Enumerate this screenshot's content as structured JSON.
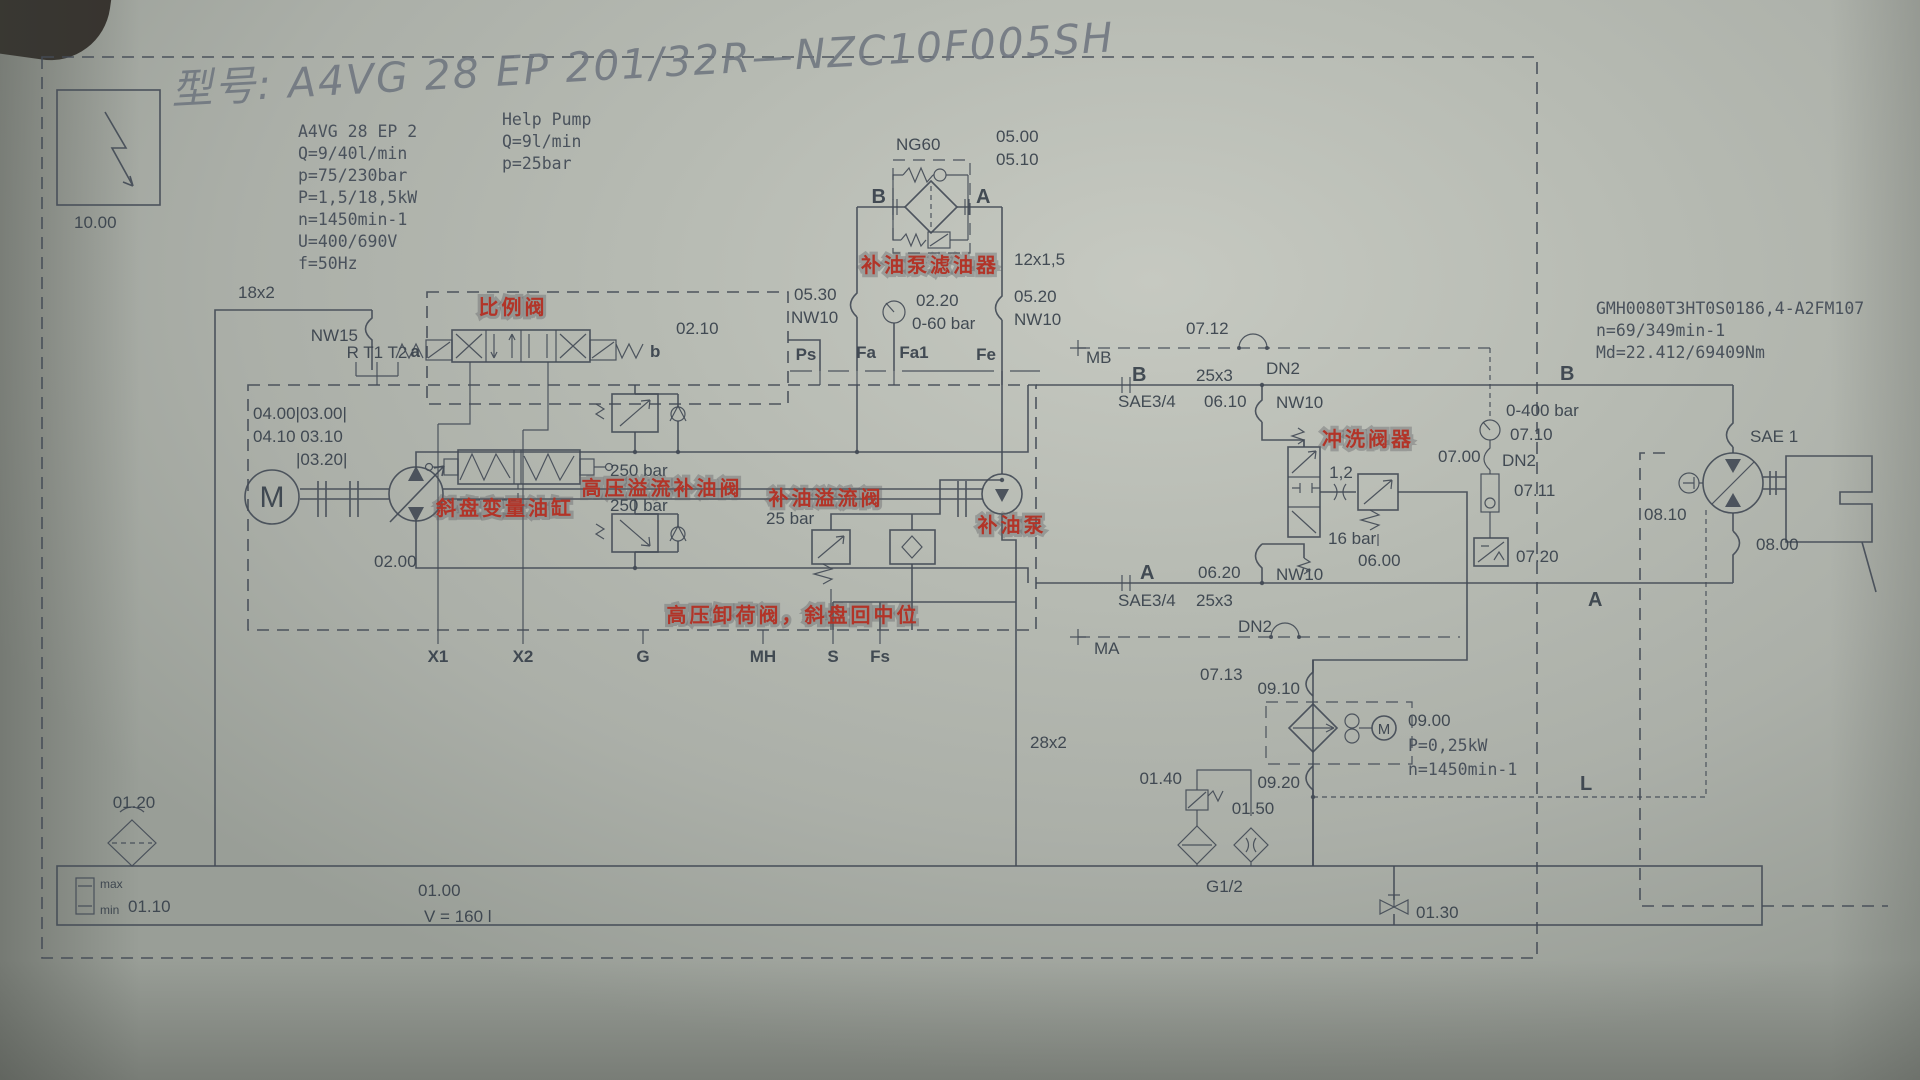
{
  "hand": {
    "title": "型号: A4VG 28 EP 201/32R—NZC10F005SH"
  },
  "box10": {
    "code": "10.00"
  },
  "pump_specs": {
    "l1": "A4VG 28 EP 2",
    "l2": "Q=9/40l/min",
    "l3": "p=75/230bar",
    "l4": "P=1,5/18,5kW",
    "l5": "n=1450min-1",
    "l6": "U=400/690V",
    "l7": "f=50Hz"
  },
  "help_pump": {
    "l1": "Help Pump",
    "l2": "Q=9l/min",
    "l3": "p=25bar"
  },
  "ng60": {
    "name": "NG60",
    "c0500": "05.00",
    "c0510": "05.10",
    "b": "B",
    "a": "A",
    "pipe": "12x1,5",
    "red": "补油泵滤油器"
  },
  "gaugerow": {
    "c0530": "05.30",
    "nw10l": "NW10",
    "c0220": "02.20",
    "range": "0-60 bar",
    "c0520": "05.20",
    "nw10r": "NW10"
  },
  "ports_top": {
    "ps": "Ps",
    "fa": "Fa",
    "fa1": "Fa1",
    "fe": "Fe"
  },
  "left": {
    "p18": "18x2",
    "nw15": "NW15",
    "rt": "R T1 T2"
  },
  "pv": {
    "red": "比例阀",
    "a": "a",
    "b": "b",
    "code": "02.10"
  },
  "codes": {
    "l1": "04.00|03.00|",
    "l2": "04.10 03.10",
    "l3": "|03.20|"
  },
  "pump": {
    "m": "M",
    "code": "02.00",
    "r1": "250 bar",
    "r2": "250 bar",
    "red_hp": "高压溢流补油阀",
    "red_sw": "斜盘变量油缸",
    "cr": "25 bar",
    "red_cr": "补油溢流阀",
    "red_cp": "补油泵",
    "red_unload": "高压卸荷阀，斜盘回中位",
    "pipe28": "28x2"
  },
  "ports_bottom": {
    "x1": "X1",
    "x2": "X2",
    "g": "G",
    "mh": "MH",
    "s": "S",
    "fs": "Fs"
  },
  "lineb": {
    "mb": "MB",
    "b": "B",
    "p25": "25x3",
    "dn2": "DN2",
    "c0712": "07.12",
    "sae": "SAE3/4",
    "c0610": "06.10",
    "nw10": "NW10",
    "bright": "B"
  },
  "linea": {
    "a": "A",
    "c0620": "06.20",
    "nw10": "NW10",
    "sae": "SAE3/4",
    "p25": "25x3",
    "ma": "MA",
    "dn2": "DN2",
    "c0713": "07.13",
    "aright": "A"
  },
  "motor_specs": {
    "l1": "GMH0080T3HT0S0186,4-A2FM107",
    "l2": "n=69/349min-1",
    "l3": "Md=22.412/69409Nm"
  },
  "flush": {
    "red": "冲洗阀器",
    "c0700": "07.00",
    "orif": "1,2",
    "relief": "16 bar",
    "code": "06.00"
  },
  "test": {
    "range": "0-400 bar",
    "c0710": "07.10",
    "dn2": "DN2",
    "c0711": "07.11",
    "c0720": "07.20"
  },
  "motor": {
    "sae": "SAE 1",
    "c0810": "08.10",
    "code": "08.00",
    "l": "L"
  },
  "cooler": {
    "c0910": "09.10",
    "code": "09.00",
    "p": "P=0,25kW",
    "n": "n=1450min-1",
    "c0920": "09.20",
    "m": "M"
  },
  "tank": {
    "c0140": "01.40",
    "c0150": "01.50",
    "g12": "G1/2",
    "c0130": "01.30",
    "c0120": "01.20",
    "c0110": "01.10",
    "max": "max",
    "min": "min",
    "code": "01.00",
    "vol": "V = 160 l"
  }
}
